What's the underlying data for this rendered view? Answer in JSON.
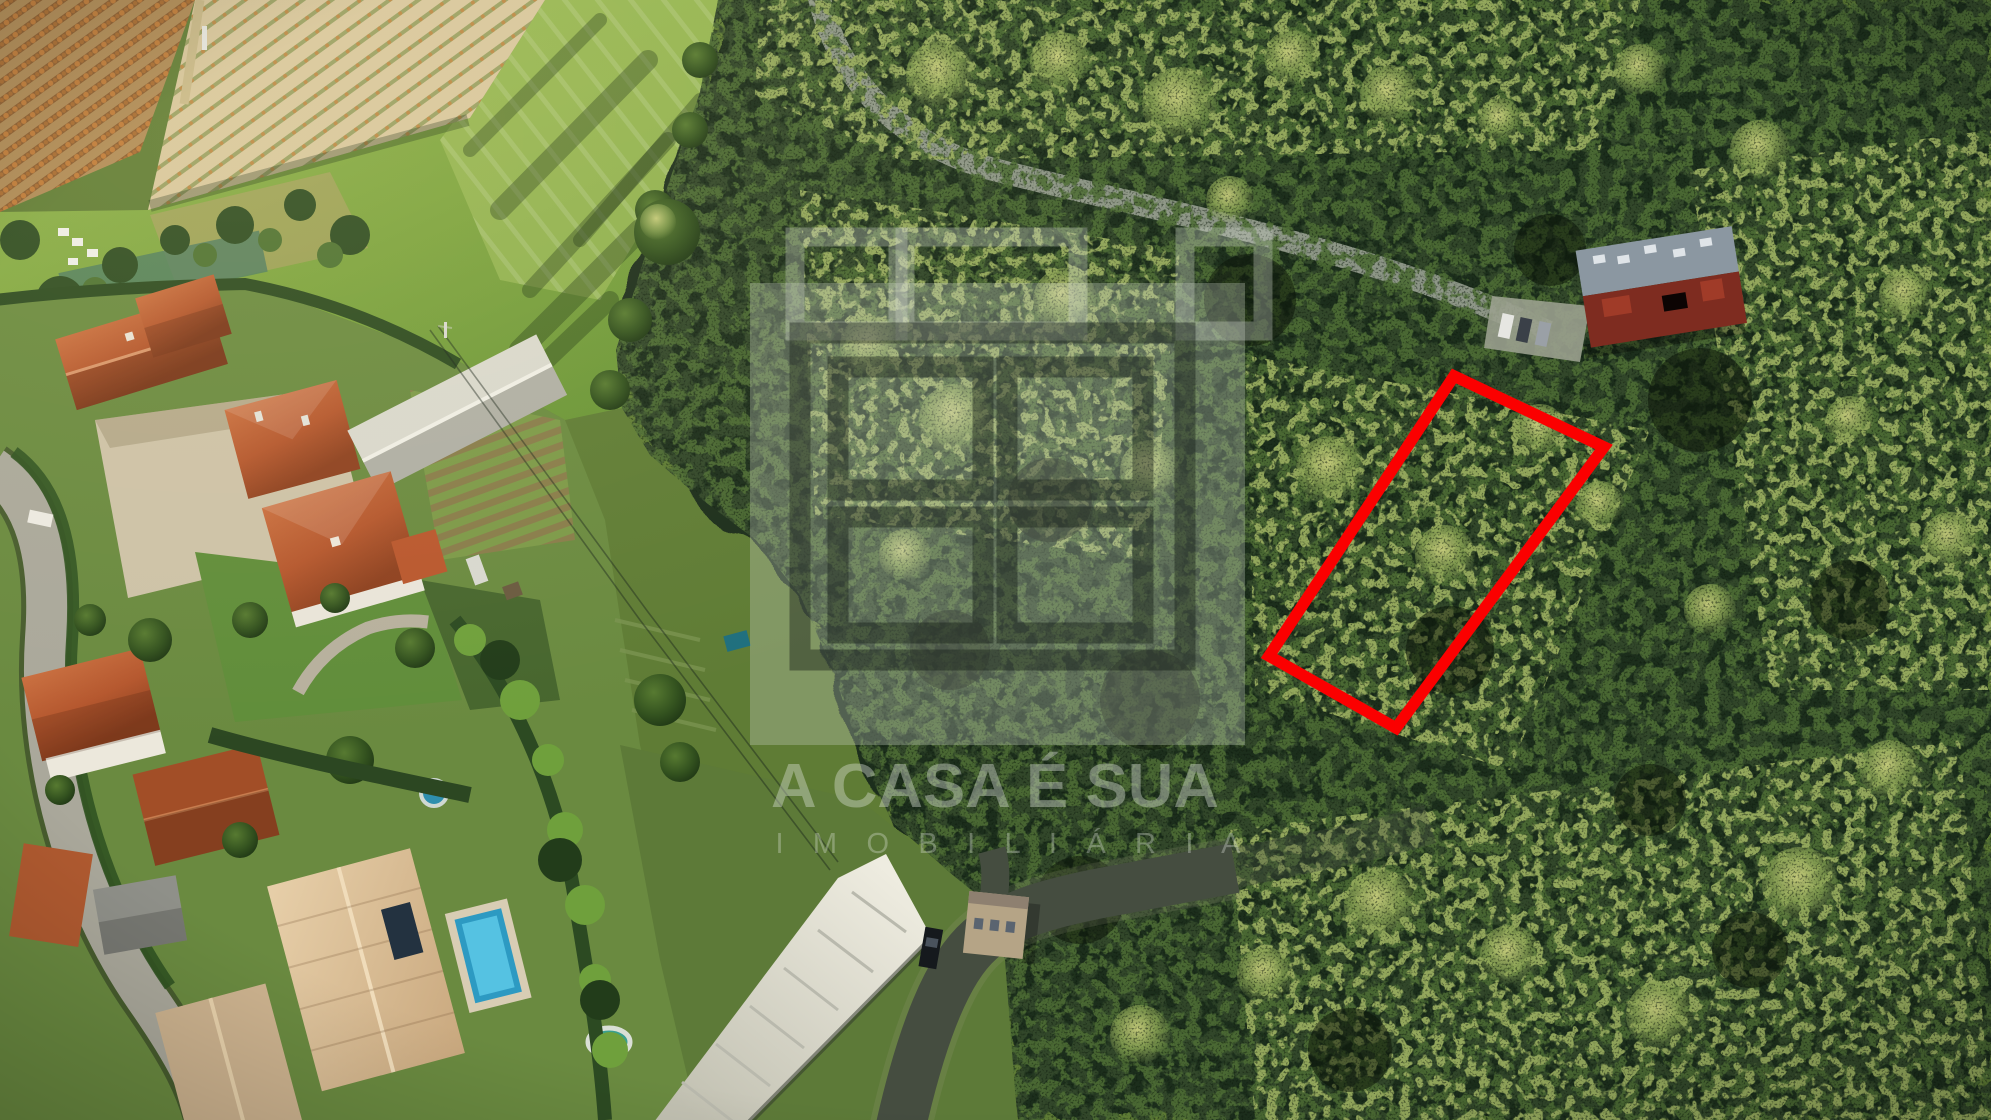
{
  "watermark": {
    "title": "A CASA É SUA",
    "subtitle": "I M O B I L I Á R I A"
  },
  "plot_marker": {
    "color": "#FB0000"
  },
  "scene": {
    "palette": {
      "forest_dark": "#1E2D1B",
      "forest_mid": "#31472A",
      "forest_highlight": "#93A75C",
      "pasture_green": "#84A847",
      "vineyard_soil": "#B08A56",
      "roof_terracotta": "#B5572E",
      "roof_pale": "#DCBF9C",
      "pool_blue": "#2D9AC2",
      "warehouse_white": "#DDDCD2",
      "road_light": "#AAA89B",
      "road_asphalt": "#454D40",
      "industrial_roof_red": "#7E2C20",
      "industrial_roof_grey": "#8B97A1"
    }
  }
}
